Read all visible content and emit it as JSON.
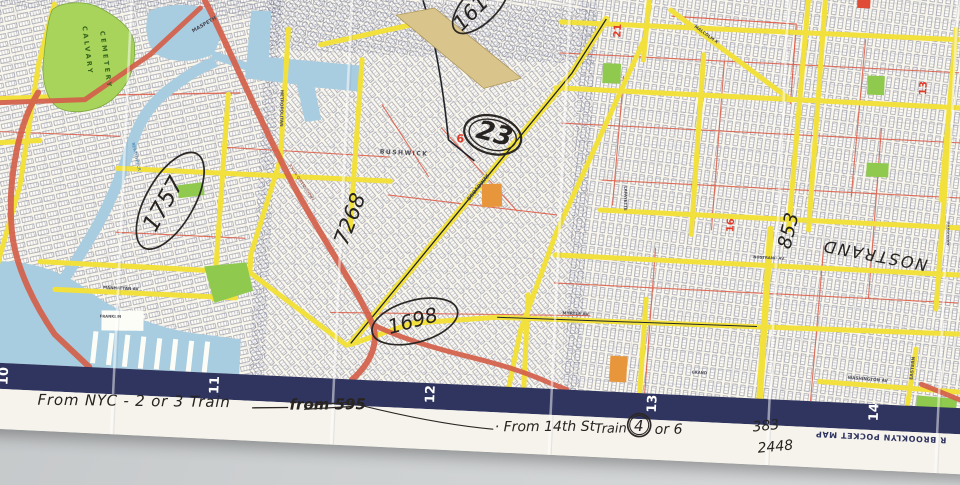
{
  "map": {
    "border_numbers": [
      "10",
      "11",
      "12",
      "13",
      "14"
    ],
    "footer_print": "R BROOKLYN POCKET MAP",
    "district_numbers": {
      "d6": "6",
      "d21": "21",
      "d13": "13",
      "d16": "16"
    },
    "place_labels": {
      "calvary": "CALVARY",
      "cemetery": "CEMETERY",
      "maspeth": "MASPETH",
      "newtown_creek": "NEWTOWN CR",
      "bushwick": "BUSHWICK",
      "metropolitan": "METROPOLITAN",
      "broadway": "BROADWAY",
      "myrtle": "MYRTLE AV",
      "manhattan": "MANHATTAN AV",
      "nostrand": "NOSTRAND AV",
      "washington": "WASHINGTON AV",
      "eastern": "EASTERN",
      "parkway": "PARKWAY",
      "malcolm_x": "MALCOLM X",
      "lafayette": "LAFAYETTE",
      "grand": "GRAND",
      "franklin": "FRANKLIN",
      "expressway": "B'KLYN-QUEENS EXPWY"
    }
  },
  "handwriting": {
    "map_notes": {
      "n1757": "1757",
      "n7268": "7268",
      "n23": "23",
      "n1698": "1698",
      "n1614": "1614",
      "n853": "853",
      "nostrand": "NOSTRAND"
    },
    "margin_notes": {
      "from_nyc": "From NYC - 2 or 3 Train",
      "from_595": "from 595",
      "from_14th": "· From 14th St",
      "train_word": "Train",
      "train_number": "4",
      "or_6": "or 6",
      "n383": "383",
      "n2448": "2448"
    }
  },
  "colors": {
    "paper": "#f9f6ec",
    "margin_paper": "#f6f3ec",
    "border_strip": "#30355f",
    "street_yellow": "#f2e13c",
    "highway_orange": "#d4604a",
    "water_blue": "#a9cde0",
    "park_green": "#8fc94e",
    "cemetery_green": "#a8d45c",
    "red_print": "#dd5a45",
    "table_gray": "#c9cccd",
    "ink": "#262320"
  }
}
